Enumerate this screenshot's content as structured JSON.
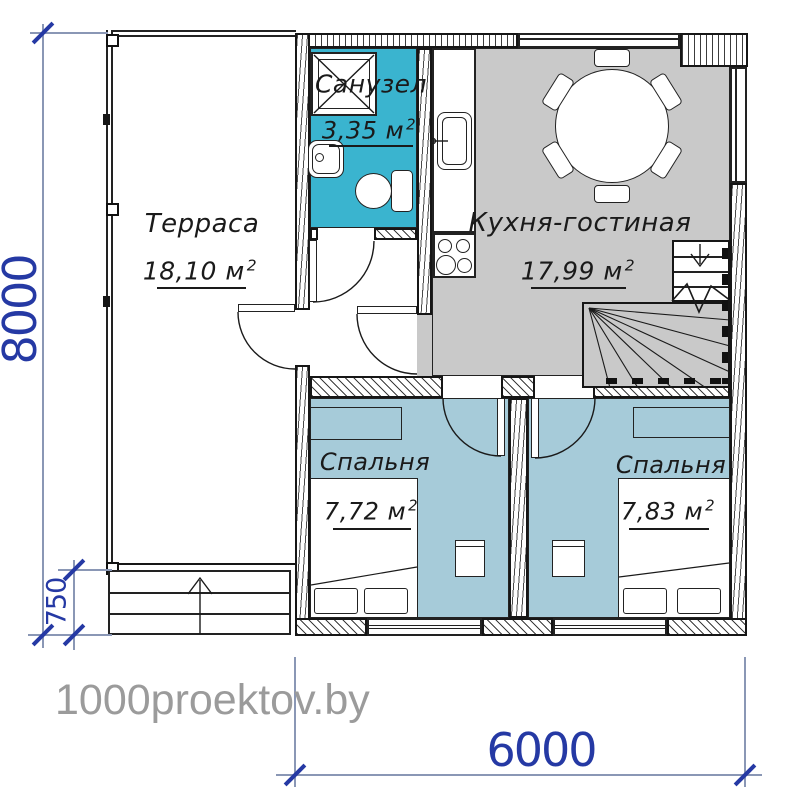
{
  "rooms": {
    "terrace": {
      "name": "Терраса",
      "area": "18,10 м",
      "sup": "2"
    },
    "bathroom": {
      "name": "Санузел",
      "area": "3,35 м",
      "sup": "2"
    },
    "kitchen": {
      "name": "Кухня-гостиная",
      "area": "17,99 м",
      "sup": "2"
    },
    "bedroom1": {
      "name": "Спальня",
      "area": "7,72 м",
      "sup": "2"
    },
    "bedroom2": {
      "name": "Спальня",
      "area": "7,83 м",
      "sup": "2"
    }
  },
  "dimensions": {
    "height_total": "8000",
    "steps_height": "750",
    "width_main": "6000"
  },
  "watermark": "1000proektov.by",
  "colors": {
    "bathroom_floor": "#3ab4cf",
    "bedroom_floor": "#a6cbd9",
    "kitchen_floor": "#c9c9c9",
    "dimension_text": "#2539a4",
    "dimension_line": "#8a97b5",
    "watermark": "#9b9b9b",
    "line": "#1a1a1a"
  }
}
